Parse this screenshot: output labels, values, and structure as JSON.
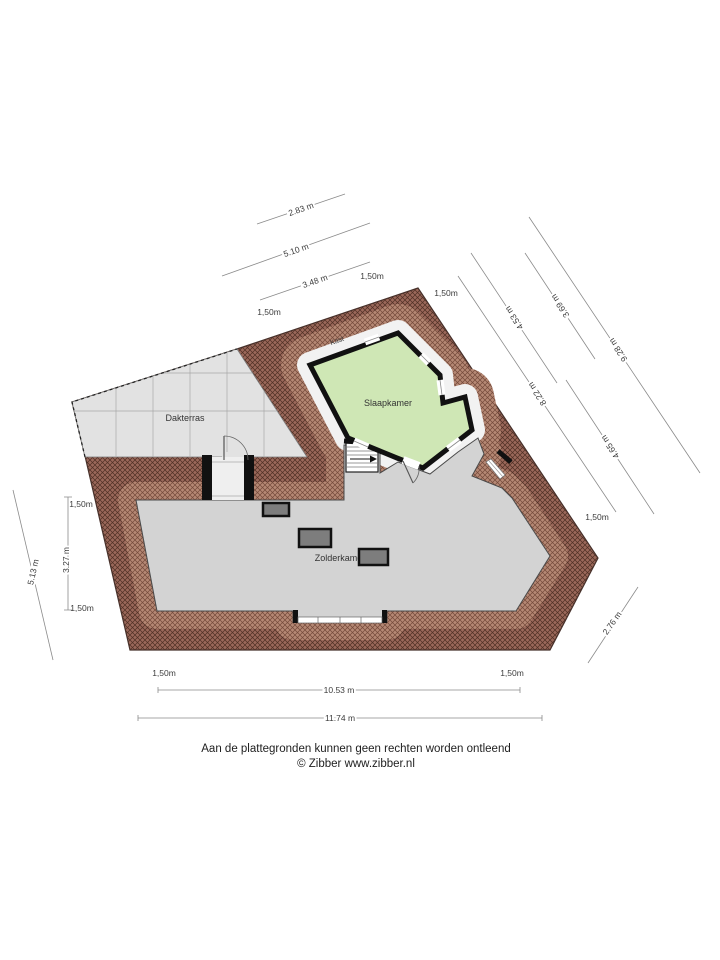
{
  "rooms": {
    "dakterras": "Dakterras",
    "slaapkamer": "Slaapkamer",
    "zolderkamer": "Zolderkamer",
    "kast": "Kast"
  },
  "dimensions": [
    {
      "label": "2.83 m"
    },
    {
      "label": "5.10 m"
    },
    {
      "label": "3.48 m"
    },
    {
      "label": "1,50m"
    },
    {
      "label": "1,50m"
    },
    {
      "label": "1,50m"
    },
    {
      "label": "3.69 m"
    },
    {
      "label": "4.53 m"
    },
    {
      "label": "9.28 m"
    },
    {
      "label": "8.22 m"
    },
    {
      "label": "4.65 m"
    },
    {
      "label": "1,50m"
    },
    {
      "label": "2.76 m"
    },
    {
      "label": "1,50m"
    },
    {
      "label": "3.27 m"
    },
    {
      "label": "1,50m"
    },
    {
      "label": "5.13 m"
    },
    {
      "label": "1,50m"
    },
    {
      "label": "1,50m"
    },
    {
      "label": "10.53 m"
    },
    {
      "label": "11.74 m"
    }
  ],
  "footer": {
    "line1": "Aan de plattegronden kunnen geen rechten worden ontleend",
    "line2": "© Zibber www.zibber.nl"
  },
  "colors": {
    "roof_base": "#9a685a",
    "roof_hatch": "#4f2f24",
    "roof_light": "#b58874",
    "roof_light_hatch": "#74493a",
    "terrace": "#e2e2e2",
    "terrace_grid": "#a8a8a8",
    "room_gray": "#d3d3d3",
    "room_green": "#cfe7b5",
    "skylight": "#7d7d7d",
    "wall": "#111111",
    "dim_line": "#8a8a8a"
  }
}
